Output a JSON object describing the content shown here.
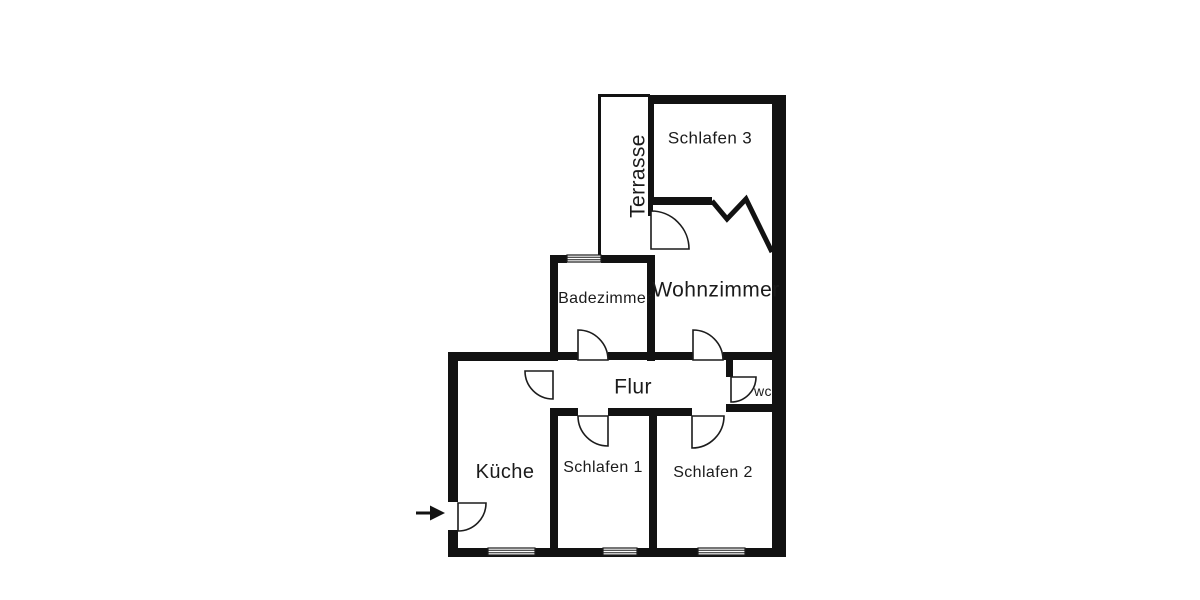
{
  "floorplan": {
    "type": "apartment-floor-plan",
    "colors": {
      "wall": "#121212",
      "background": "#ffffff"
    },
    "rooms": [
      {
        "id": "schlafen-3",
        "label": "Schlafen 3"
      },
      {
        "id": "terrasse",
        "label": "Terrasse"
      },
      {
        "id": "badezimmer",
        "label": "Badezimmer"
      },
      {
        "id": "wohnzimmer",
        "label": "Wohnzimmer"
      },
      {
        "id": "flur",
        "label": "Flur"
      },
      {
        "id": "wc",
        "label": "wc"
      },
      {
        "id": "kueche",
        "label": "Küche"
      },
      {
        "id": "schlafen-1",
        "label": "Schlafen 1"
      },
      {
        "id": "schlafen-2",
        "label": "Schlafen 2"
      }
    ],
    "features": {
      "entrance_icon": "arrow-right",
      "doors": 8,
      "windows": 4,
      "folding_door_between": [
        "Schlafen 3",
        "Wohnzimmer"
      ]
    }
  }
}
